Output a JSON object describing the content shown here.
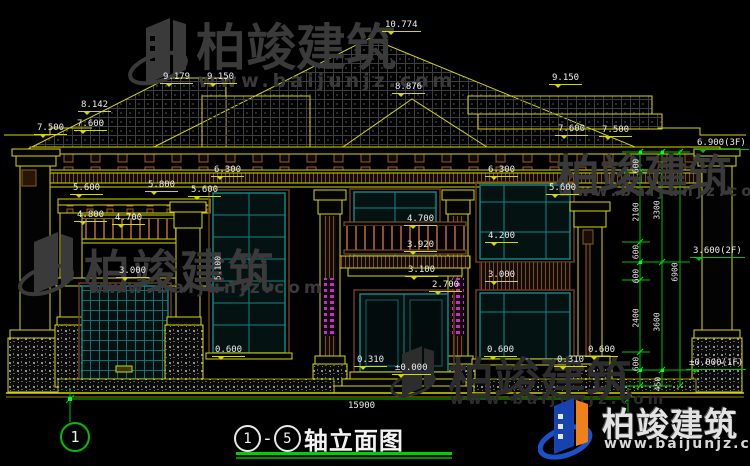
{
  "watermark": {
    "brand": "柏竣建筑",
    "site": "www.baijunjz.com"
  },
  "brand_footer": {
    "brand": "柏竣建筑",
    "site": "www.baijunjz.com"
  },
  "title": {
    "axis_start": "1",
    "axis_end": "5",
    "text": "轴立面图"
  },
  "axis_bubble": {
    "label": "1"
  },
  "dims": {
    "overall_width": "15900",
    "roof": [
      "10.774",
      "9.179",
      "9.150",
      "8.876",
      "9.150",
      "8.142",
      "7.500",
      "7.600",
      "7.600",
      "7.500"
    ],
    "left": [
      "6.300",
      "5.600",
      "5.800",
      "5.600",
      "4.800",
      "4.700",
      "3.000",
      "0.600",
      "0.310",
      "±0.000"
    ],
    "center": [
      "4.700",
      "3.920",
      "3.100",
      "2.700"
    ],
    "right": [
      "6.300",
      "5.600",
      "4.200",
      "3.000",
      "0.600",
      "0.310",
      "0.600"
    ],
    "floors": [
      "6.900(3F)",
      "3.600(2F)",
      "±0.000(1F)"
    ],
    "chain": [
      "600",
      "2100",
      "600",
      "600",
      "2400",
      "600",
      "450"
    ],
    "chain_totals": [
      "3300",
      "3600",
      "6900"
    ],
    "stair_window_height": "5.100"
  },
  "colors": {
    "line_yellow": "#d6d600",
    "dim_green": "#00c000",
    "frame_teal": "#0e8585",
    "trim_brown": "#6e3a1c",
    "ornament_magenta": "#c32fc3",
    "text_white": "#ededed"
  }
}
